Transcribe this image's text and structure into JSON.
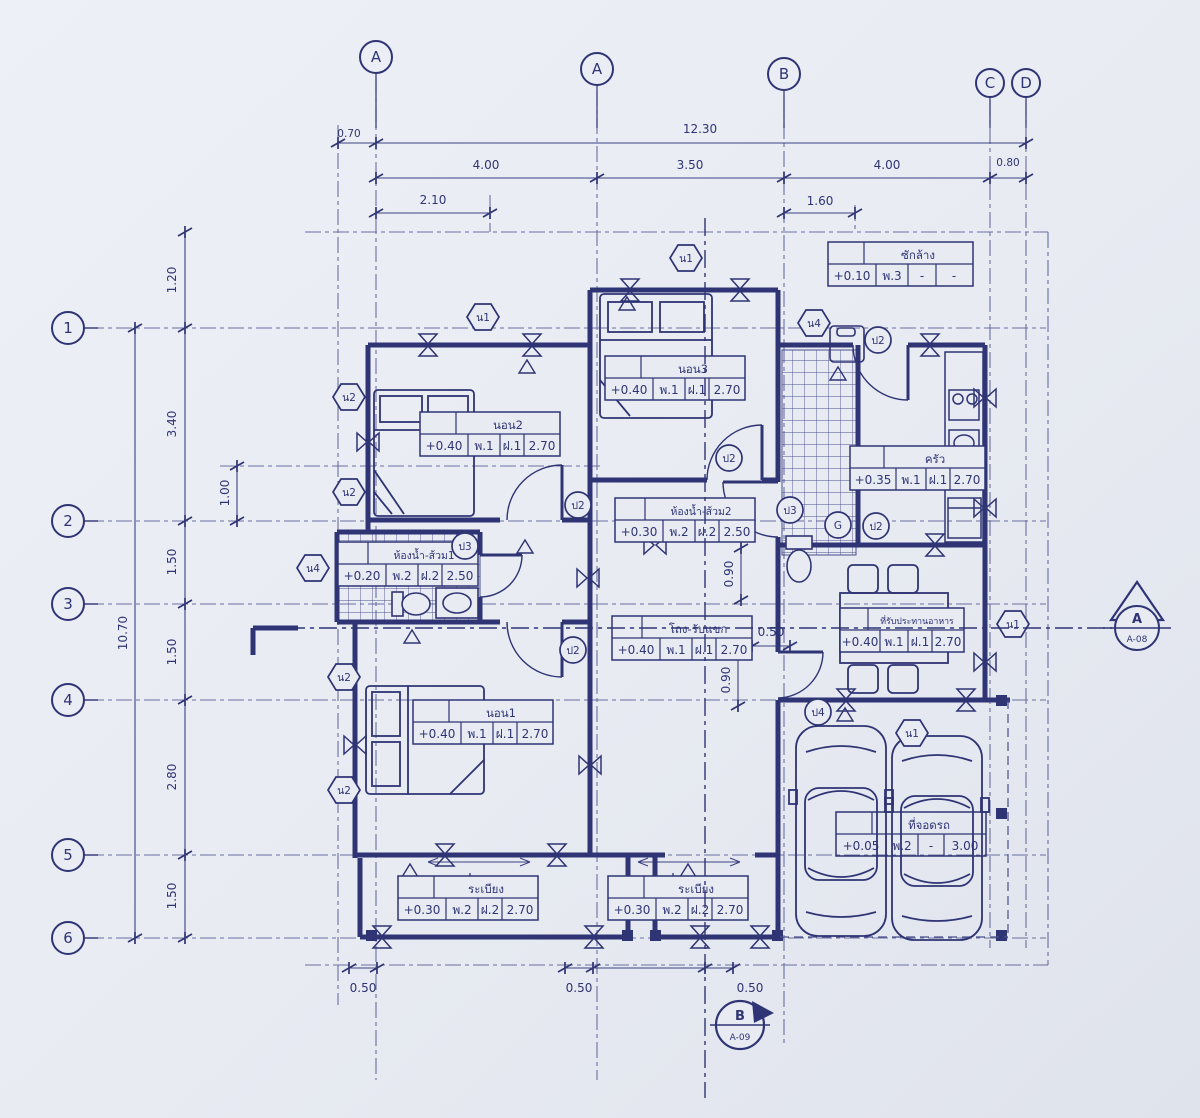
{
  "title": "Thai house floor plan blueprint",
  "colors": {
    "paper": "#e8ebf2",
    "ink": "#2f3474",
    "ink_light": "#6a6fa0"
  },
  "grid": {
    "cols": [
      "A",
      "A",
      "B",
      "C",
      "D"
    ],
    "rows": [
      "1",
      "2",
      "3",
      "4",
      "5",
      "6"
    ]
  },
  "dims": {
    "top_offset": "0.70",
    "top_total": "12.30",
    "top_a": "4.00",
    "top_b": "3.50",
    "top_c": "4.00",
    "top_d": "0.80",
    "sub_a": "2.10",
    "sub_b": "1.60",
    "left_total": "10.70",
    "l1": "1.20",
    "l2": "3.40",
    "l3": "1.50",
    "l4": "1.50",
    "l5": "2.80",
    "l6": "1.50",
    "l_sub": "1.00",
    "b1": "0.50",
    "b2": "0.50",
    "b3": "0.50",
    "i_050": "0.50",
    "i_090a": "0.90",
    "i_090b": "0.90"
  },
  "rooms": {
    "bedroom2": {
      "name": "นอน2",
      "level": "+0.40",
      "wall": "พ.1",
      "ceiling": "ฝ.1",
      "height": "2.70"
    },
    "bedroom3": {
      "name": "นอน3",
      "level": "+0.40",
      "wall": "พ.1",
      "ceiling": "ฝ.1",
      "height": "2.70"
    },
    "bedroom1": {
      "name": "นอน1",
      "level": "+0.40",
      "wall": "พ.1",
      "ceiling": "ฝ.1",
      "height": "2.70"
    },
    "laundry": {
      "name": "ซักล้าง",
      "level": "+0.10",
      "wall": "พ.3",
      "ceiling": "-",
      "height": "-"
    },
    "kitchen": {
      "name": "ครัว",
      "level": "+0.35",
      "wall": "พ.1",
      "ceiling": "ฝ.1",
      "height": "2.70"
    },
    "bath2": {
      "name": "ห้องน้ำ-ส้วม2",
      "level": "+0.30",
      "wall": "พ.2",
      "ceiling": "ฝ.2",
      "height": "2.50"
    },
    "bath1": {
      "name": "ห้องน้ำ-ส้วม1",
      "level": "+0.20",
      "wall": "พ.2",
      "ceiling": "ฝ.2",
      "height": "2.50"
    },
    "hall": {
      "name": "โถง-รับแขก",
      "level": "+0.40",
      "wall": "พ.1",
      "ceiling": "ฝ.1",
      "height": "2.70"
    },
    "dining": {
      "name": "ที่รับประทานอาหาร",
      "level": "+0.40",
      "wall": "พ.1",
      "ceiling": "ฝ.1",
      "height": "2.70"
    },
    "terrace1": {
      "name": "ระเบียง",
      "level": "+0.30",
      "wall": "พ.2",
      "ceiling": "ฝ.2",
      "height": "2.70"
    },
    "terrace2": {
      "name": "ระเบียง",
      "level": "+0.30",
      "wall": "พ.2",
      "ceiling": "ฝ.2",
      "height": "2.70"
    },
    "carport": {
      "name": "ที่จอดรถ",
      "level": "+0.05",
      "wall": "พ.2",
      "ceiling": "-",
      "height": "3.00"
    }
  },
  "markers": {
    "n1": "น1",
    "n2": "น2",
    "n4": "น4",
    "p2": "ป2",
    "p3": "ป3",
    "p4": "ป4",
    "g": "G"
  },
  "sections": {
    "right": {
      "letter": "A",
      "sheet": "A-08"
    },
    "bottom": {
      "letter": "B",
      "sheet": "A-09"
    }
  }
}
